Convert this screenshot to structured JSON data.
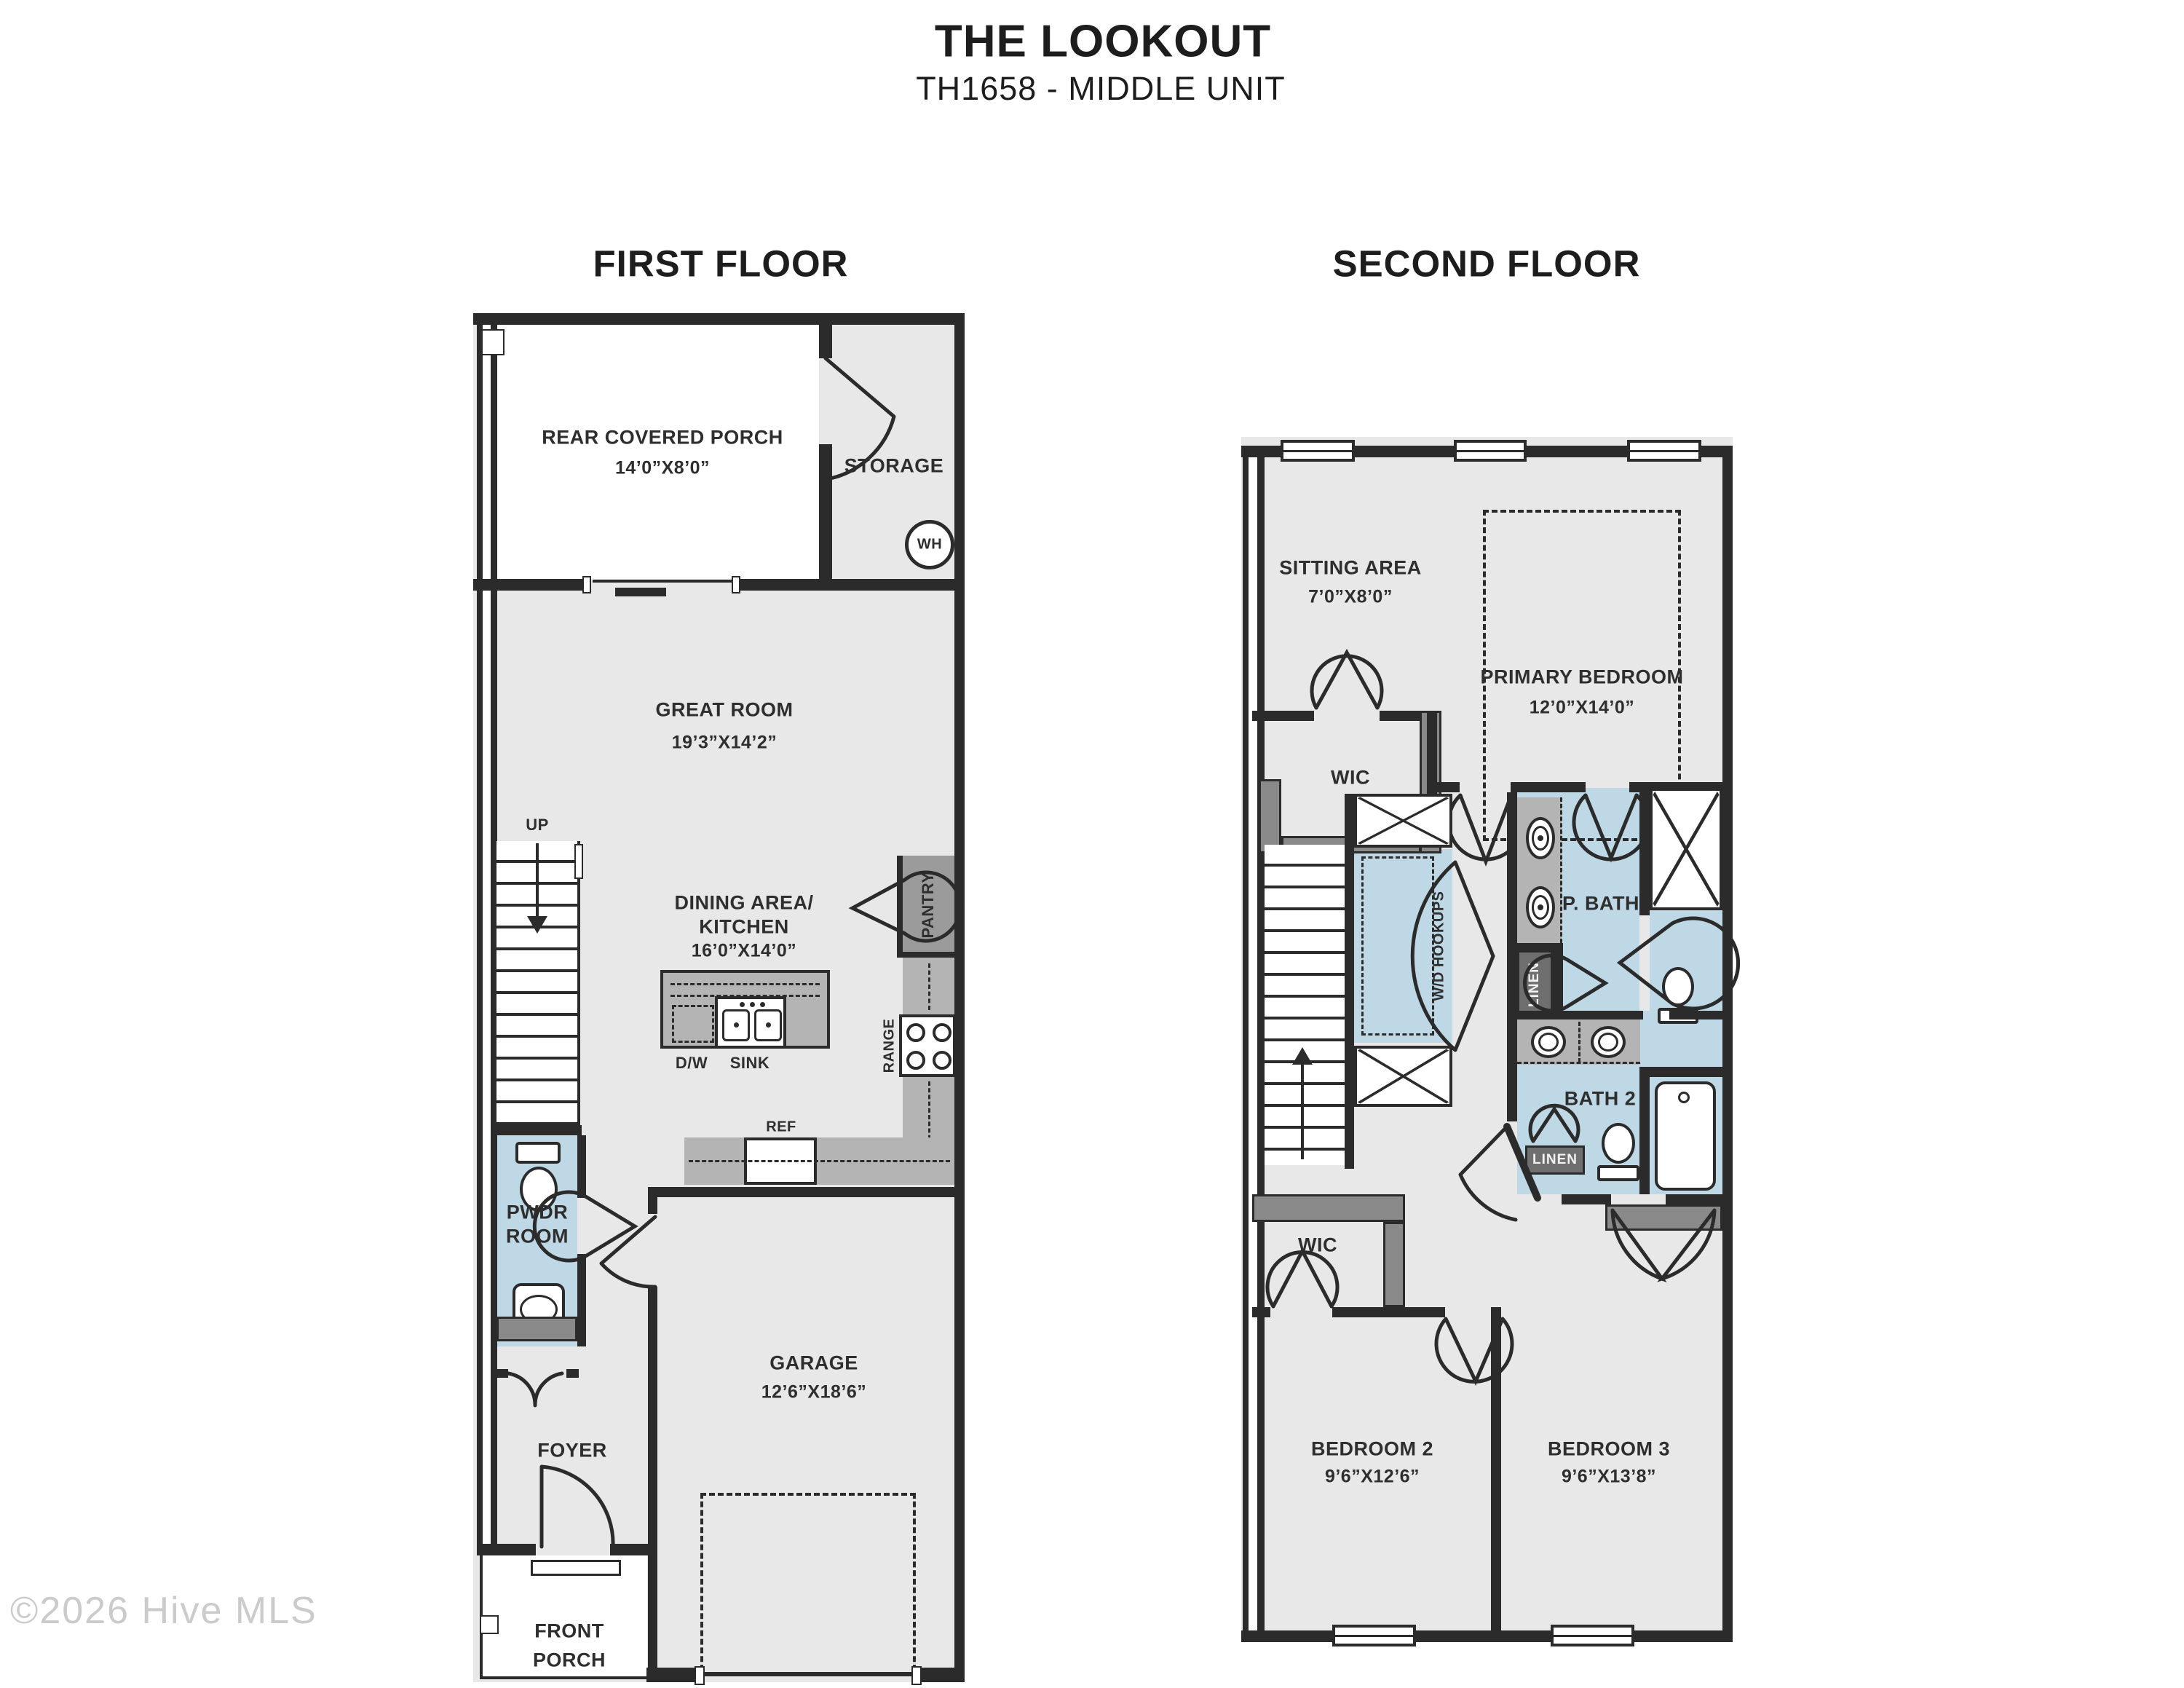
{
  "title": "THE LOOKOUT",
  "subtitle": "TH1658 - MIDDLE UNIT",
  "watermark": "©2026 Hive MLS",
  "colors": {
    "wall": "#2b2b2b",
    "floor": "#e8e8e8",
    "room_blue": "#bfd8e6",
    "counter_gray": "#b4b4b4",
    "closet_gray": "#8a8a8a",
    "linen_gray": "#6f6f6f"
  },
  "first_floor": {
    "heading": "FIRST FLOOR",
    "rear_porch_name": "REAR COVERED PORCH",
    "rear_porch_dims": "14’0”X8’0”",
    "storage": "STORAGE",
    "water_heater": "WH",
    "great_room_name": "GREAT ROOM",
    "great_room_dims": "19’3”X14’2”",
    "stairs_up": "UP",
    "dining_line1": "DINING AREA/",
    "dining_line2": "KITCHEN",
    "dining_dims": "16’0”X14’0”",
    "dishwasher": "D/W",
    "sink": "SINK",
    "pantry": "PANTRY",
    "range": "RANGE",
    "fridge": "REF",
    "powder_line1": "PWDR",
    "powder_line2": "ROOM",
    "foyer": "FOYER",
    "garage_name": "GARAGE",
    "garage_dims": "12’6”X18’6”",
    "front_porch_line1": "FRONT",
    "front_porch_line2": "PORCH"
  },
  "second_floor": {
    "heading": "SECOND FLOOR",
    "sitting_name": "SITTING AREA",
    "sitting_dims": "7’0”X8’0”",
    "primary_name": "PRIMARY BEDROOM",
    "primary_dims": "12’0”X14’0”",
    "wic_upper": "WIC",
    "wd_hookups": "W/D HOOKUPS",
    "pbath": "P. BATH",
    "linen_upper": "LINEN",
    "stairs_down": "DOWN",
    "bath2": "BATH 2",
    "linen_lower": "LINEN",
    "wic_lower": "WIC",
    "bedroom2_name": "BEDROOM 2",
    "bedroom2_dims": "9’6”X12’6”",
    "bedroom3_name": "BEDROOM 3",
    "bedroom3_dims": "9’6”X13’8”"
  }
}
